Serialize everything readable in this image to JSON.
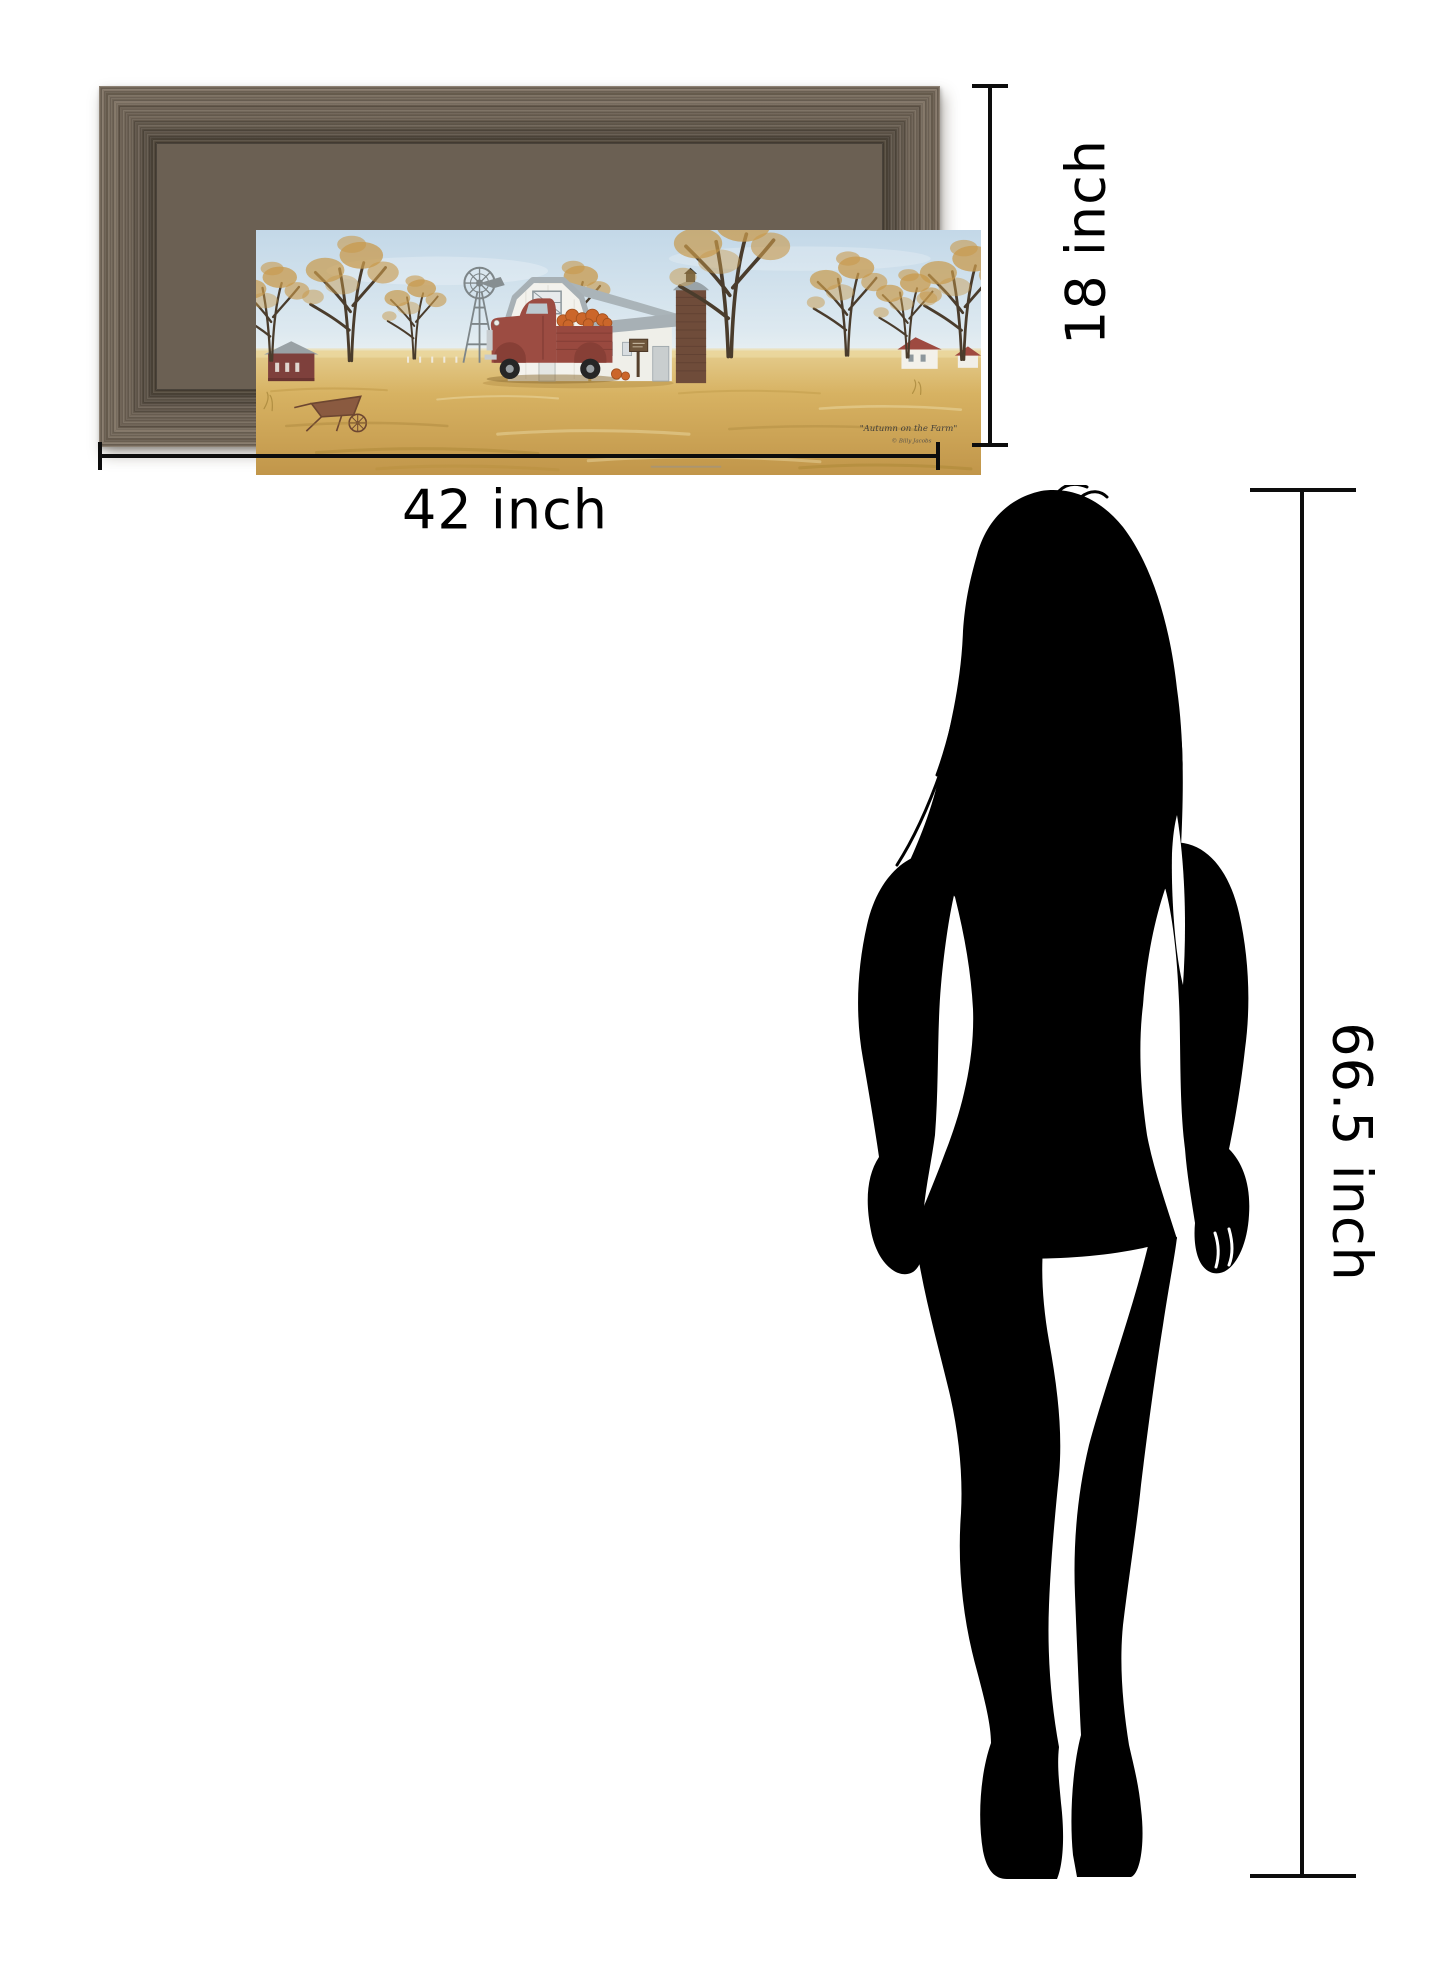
{
  "page": {
    "background_color": "#ffffff"
  },
  "framed_art": {
    "title": "\"Autumn on the Farm\"",
    "signature": "© Billy Jacobs",
    "frame_color": "#6b6053",
    "scene_colors": {
      "sky": "#cadded",
      "field_gold": "#d3ab58",
      "barn_white": "#f3f2ed",
      "roof_grey": "#a7b0b5",
      "silo_brown": "#6f4c3a",
      "truck_red": "#9c4c42",
      "pumpkin_orange": "#cb662a",
      "foliage_gold": "#c89a4c",
      "shed_red": "#7e403c"
    }
  },
  "dimension_annotations": {
    "frame_width": "42 inch",
    "frame_height": "18 inch",
    "person_height": "66.5 inch",
    "line_color": "#0d0d0d"
  },
  "person": {
    "description": "standing woman silhouette",
    "color": "#000000"
  }
}
